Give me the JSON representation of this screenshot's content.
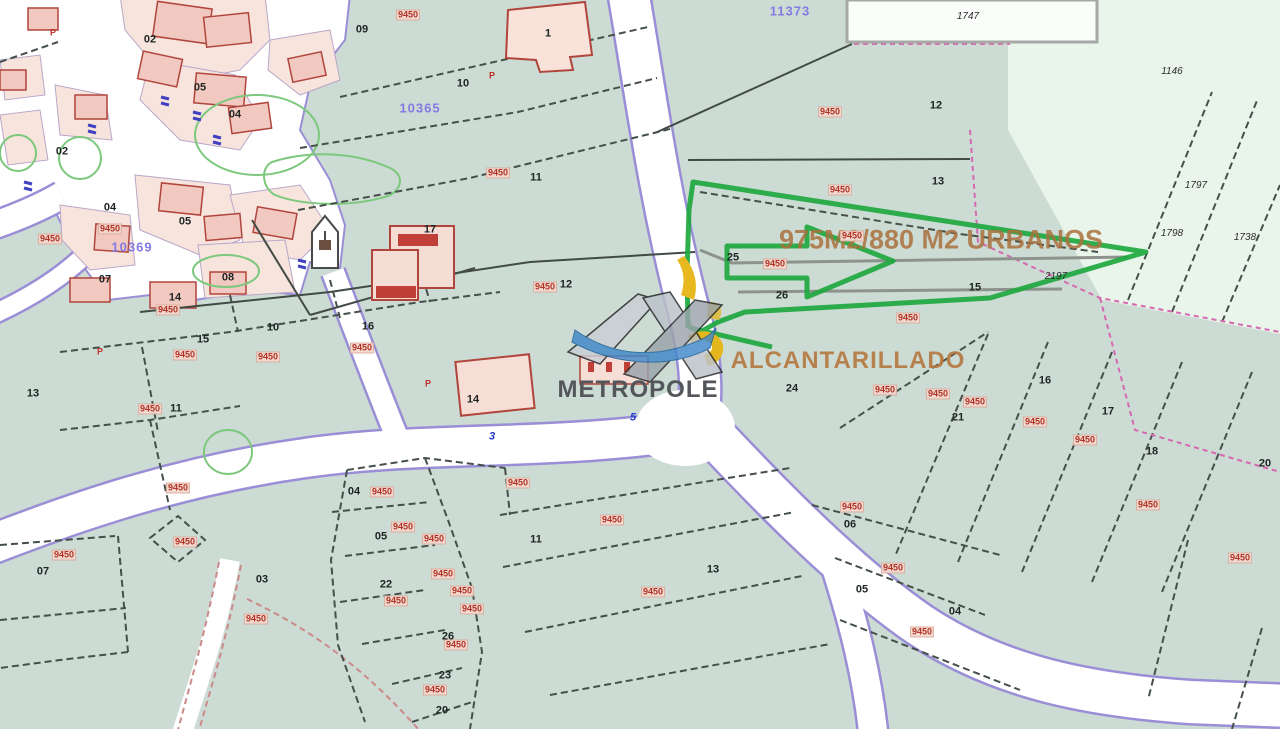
{
  "map": {
    "watermark_text": "METROPOLE",
    "area_annotation": "975M2/880 M2 URBANOS",
    "utility_annotation": "ALCANTARILLADO",
    "colors": {
      "base_green": "#ccdbd3",
      "mint_green": "#e9f4ea",
      "road_white": "#ffffff",
      "road_border_purple": "#9a8ed6",
      "building_pink": "#f6ded6",
      "building_outline_red": "#b0453c",
      "highlight_green": "#1ea83e",
      "zone_label_red": "#b23226",
      "zone_code_purple": "#837ae4",
      "annotation_brown": "#a9713d",
      "watermark_gray": "#53565a",
      "symbol_yellow": "#e8b820"
    },
    "zone_codes": [
      {
        "t": "11373",
        "x": 790,
        "y": 11
      },
      {
        "t": "10365",
        "x": 420,
        "y": 108
      },
      {
        "t": "10369",
        "x": 132,
        "y": 247
      }
    ],
    "parcel_numbers": [
      {
        "t": "09",
        "x": 362,
        "y": 30
      },
      {
        "t": "10",
        "x": 463,
        "y": 84
      },
      {
        "t": "11",
        "x": 536,
        "y": 178
      },
      {
        "t": "17",
        "x": 430,
        "y": 230
      },
      {
        "t": "12",
        "x": 566,
        "y": 285
      },
      {
        "t": "12",
        "x": 936,
        "y": 106
      },
      {
        "t": "13",
        "x": 938,
        "y": 182
      },
      {
        "t": "15",
        "x": 975,
        "y": 288
      },
      {
        "t": "25",
        "x": 733,
        "y": 258
      },
      {
        "t": "26",
        "x": 782,
        "y": 296
      },
      {
        "t": "24",
        "x": 792,
        "y": 389
      },
      {
        "t": "16",
        "x": 1045,
        "y": 381
      },
      {
        "t": "21",
        "x": 958,
        "y": 418
      },
      {
        "t": "17",
        "x": 1108,
        "y": 412
      },
      {
        "t": "18",
        "x": 1152,
        "y": 452
      },
      {
        "t": "20",
        "x": 1265,
        "y": 464
      },
      {
        "t": "11",
        "x": 536,
        "y": 540
      },
      {
        "t": "13",
        "x": 713,
        "y": 570
      },
      {
        "t": "06",
        "x": 850,
        "y": 525
      },
      {
        "t": "05",
        "x": 862,
        "y": 590
      },
      {
        "t": "04",
        "x": 955,
        "y": 612
      },
      {
        "t": "07",
        "x": 43,
        "y": 572
      },
      {
        "t": "13",
        "x": 33,
        "y": 394
      },
      {
        "t": "11",
        "x": 176,
        "y": 409
      },
      {
        "t": "03",
        "x": 262,
        "y": 580
      },
      {
        "t": "02",
        "x": 150,
        "y": 40
      },
      {
        "t": "05",
        "x": 200,
        "y": 88
      },
      {
        "t": "04",
        "x": 235,
        "y": 115
      },
      {
        "t": "02",
        "x": 62,
        "y": 152
      },
      {
        "t": "04",
        "x": 110,
        "y": 208
      },
      {
        "t": "05",
        "x": 185,
        "y": 222
      },
      {
        "t": "07",
        "x": 105,
        "y": 280
      },
      {
        "t": "08",
        "x": 228,
        "y": 278
      },
      {
        "t": "14",
        "x": 175,
        "y": 298
      },
      {
        "t": "15",
        "x": 203,
        "y": 340
      },
      {
        "t": "16",
        "x": 368,
        "y": 327
      },
      {
        "t": "10",
        "x": 273,
        "y": 328
      },
      {
        "t": "04",
        "x": 354,
        "y": 492
      },
      {
        "t": "05",
        "x": 381,
        "y": 537
      },
      {
        "t": "22",
        "x": 386,
        "y": 585
      },
      {
        "t": "26",
        "x": 448,
        "y": 637
      },
      {
        "t": "23",
        "x": 445,
        "y": 676
      },
      {
        "t": "20",
        "x": 442,
        "y": 711
      },
      {
        "t": "1",
        "x": 548,
        "y": 34
      },
      {
        "t": "14",
        "x": 473,
        "y": 400
      }
    ],
    "zone_labels": [
      {
        "t": "9450",
        "x": 408,
        "y": 15
      },
      {
        "t": "9450",
        "x": 498,
        "y": 173
      },
      {
        "t": "9450",
        "x": 545,
        "y": 287
      },
      {
        "t": "9450",
        "x": 830,
        "y": 112
      },
      {
        "t": "9450",
        "x": 840,
        "y": 190
      },
      {
        "t": "9450",
        "x": 852,
        "y": 236
      },
      {
        "t": "9450",
        "x": 775,
        "y": 264
      },
      {
        "t": "9450",
        "x": 908,
        "y": 318
      },
      {
        "t": "9450",
        "x": 885,
        "y": 390
      },
      {
        "t": "9450",
        "x": 938,
        "y": 394
      },
      {
        "t": "9450",
        "x": 975,
        "y": 402
      },
      {
        "t": "9450",
        "x": 1035,
        "y": 422
      },
      {
        "t": "9450",
        "x": 1085,
        "y": 440
      },
      {
        "t": "9450",
        "x": 1148,
        "y": 505
      },
      {
        "t": "9450",
        "x": 1240,
        "y": 558
      },
      {
        "t": "9450",
        "x": 612,
        "y": 520
      },
      {
        "t": "9450",
        "x": 653,
        "y": 592
      },
      {
        "t": "9450",
        "x": 518,
        "y": 483
      },
      {
        "t": "9450",
        "x": 852,
        "y": 507
      },
      {
        "t": "9450",
        "x": 893,
        "y": 568
      },
      {
        "t": "9450",
        "x": 922,
        "y": 632
      },
      {
        "t": "9450",
        "x": 64,
        "y": 555
      },
      {
        "t": "9450",
        "x": 150,
        "y": 409
      },
      {
        "t": "9450",
        "x": 256,
        "y": 619
      },
      {
        "t": "9450",
        "x": 178,
        "y": 488
      },
      {
        "t": "9450",
        "x": 185,
        "y": 542
      },
      {
        "t": "9450",
        "x": 50,
        "y": 239
      },
      {
        "t": "9450",
        "x": 110,
        "y": 229
      },
      {
        "t": "9450",
        "x": 168,
        "y": 310
      },
      {
        "t": "9450",
        "x": 185,
        "y": 355
      },
      {
        "t": "9450",
        "x": 268,
        "y": 357
      },
      {
        "t": "9450",
        "x": 362,
        "y": 348
      },
      {
        "t": "9450",
        "x": 382,
        "y": 492
      },
      {
        "t": "9450",
        "x": 403,
        "y": 527
      },
      {
        "t": "9450",
        "x": 434,
        "y": 539
      },
      {
        "t": "9450",
        "x": 396,
        "y": 601
      },
      {
        "t": "9450",
        "x": 443,
        "y": 574
      },
      {
        "t": "9450",
        "x": 462,
        "y": 591
      },
      {
        "t": "9450",
        "x": 472,
        "y": 609
      },
      {
        "t": "9450",
        "x": 456,
        "y": 645
      },
      {
        "t": "9450",
        "x": 435,
        "y": 690
      }
    ],
    "ref_numbers": [
      {
        "t": "1747",
        "x": 968,
        "y": 17
      },
      {
        "t": "1146",
        "x": 1172,
        "y": 72
      },
      {
        "t": "1797",
        "x": 1196,
        "y": 186
      },
      {
        "t": "1798",
        "x": 1172,
        "y": 234
      },
      {
        "t": "2197",
        "x": 1056,
        "y": 277
      },
      {
        "t": "1738",
        "x": 1245,
        "y": 238
      }
    ],
    "road_numbers": [
      {
        "t": "5",
        "x": 633,
        "y": 418
      },
      {
        "t": "3",
        "x": 492,
        "y": 437
      }
    ],
    "marker_letters": [
      {
        "t": "P",
        "x": 53,
        "y": 33
      },
      {
        "t": "P",
        "x": 492,
        "y": 76
      },
      {
        "t": "P",
        "x": 100,
        "y": 352
      },
      {
        "t": "P",
        "x": 428,
        "y": 384
      }
    ]
  }
}
